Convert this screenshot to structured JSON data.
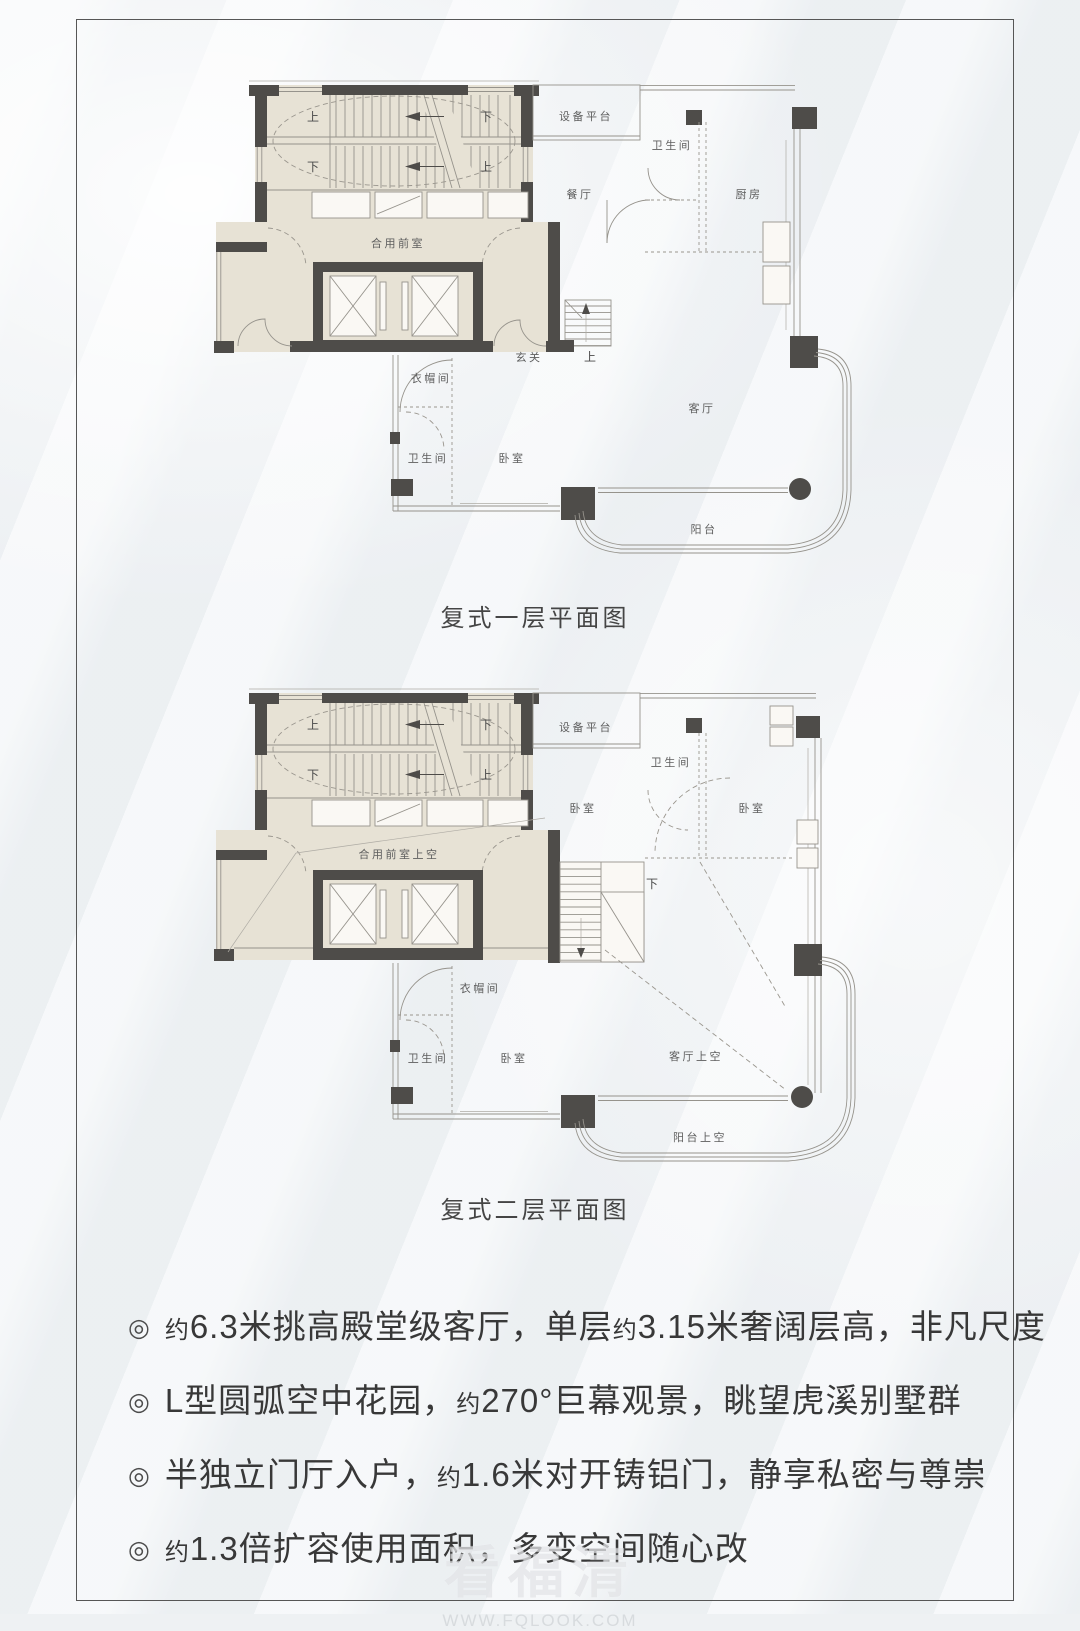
{
  "stair": {
    "tl": "上",
    "tr": "下",
    "bl": "下",
    "br": "上"
  },
  "plan1": {
    "caption": "复式一层平面图",
    "labels": {
      "vestibule": "合用前室",
      "equipment": "设备平台",
      "bath_up": "卫生间",
      "dining": "餐厅",
      "kitchen": "厨房",
      "foyer": "玄关",
      "up": "上",
      "cloak": "衣帽间",
      "bath_low": "卫生间",
      "bedroom": "卧室",
      "living": "客厅",
      "balcony": "阳台"
    }
  },
  "plan2": {
    "caption": "复式二层平面图",
    "labels": {
      "vestibule_void": "合用前室上空",
      "equipment": "设备平台",
      "bath_up": "卫生间",
      "bedroom_l": "卧室",
      "bedroom_r": "卧室",
      "down": "下",
      "cloak": "衣帽间",
      "bath_low": "卫生间",
      "bedroom_low": "卧室",
      "living_void": "客厅上空",
      "balcony_void": "阳台上空"
    }
  },
  "bullets": {
    "marker": "◎",
    "items": [
      {
        "segments": [
          {
            "text": "约",
            "small": true
          },
          {
            "text": "6.3米挑高殿堂级客厅，单层",
            "small": false
          },
          {
            "text": "约",
            "small": true
          },
          {
            "text": "3.15米奢阔层高，非凡尺度",
            "small": false
          }
        ]
      },
      {
        "segments": [
          {
            "text": "L型圆弧空中花园，",
            "small": false
          },
          {
            "text": "约",
            "small": true
          },
          {
            "text": "270°巨幕观景，眺望虎溪别墅群",
            "small": false
          }
        ]
      },
      {
        "segments": [
          {
            "text": "半独立门厅入户，",
            "small": false
          },
          {
            "text": "约",
            "small": true
          },
          {
            "text": "1.6米对开铸铝门，静享私密与尊崇",
            "small": false
          }
        ]
      },
      {
        "segments": [
          {
            "text": "约",
            "small": true
          },
          {
            "text": "1.3倍扩容使用面积，多变空间随心改",
            "small": false
          }
        ]
      }
    ]
  },
  "watermark": {
    "title": "看福清",
    "url": "WWW.FQLOOK.COM"
  }
}
